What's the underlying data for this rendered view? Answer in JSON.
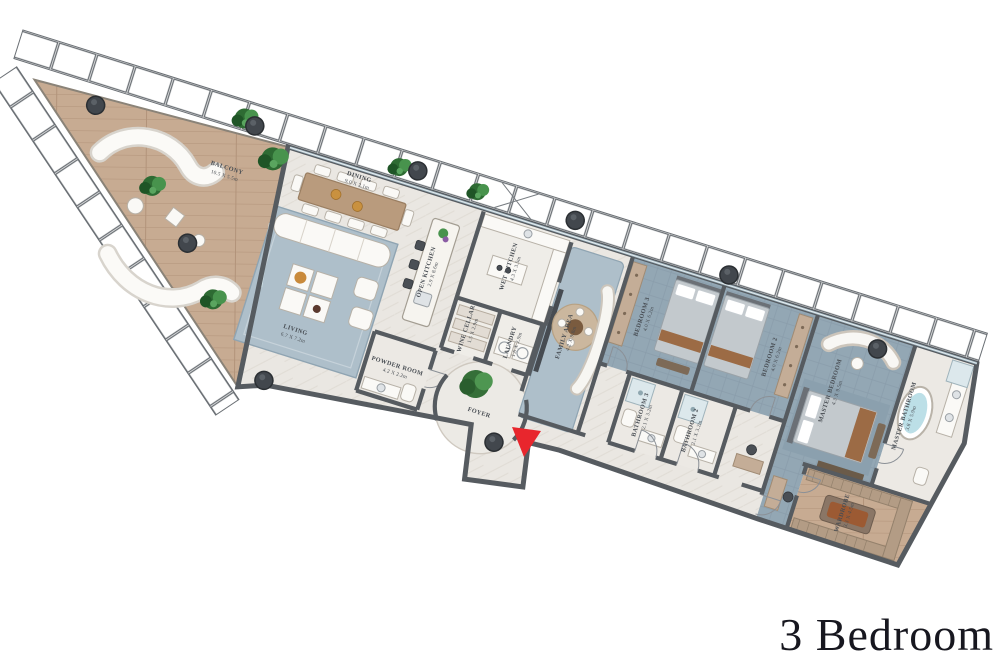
{
  "title": "3 Bedroom",
  "colors": {
    "arrow": "#e8262d",
    "wood": "#c7ab92",
    "marble": "#eae7e2",
    "carpet": "#93a7b4",
    "wall": "#565b60",
    "title_text": "#17171f"
  },
  "plan": {
    "rooms": {
      "balcony": {
        "name": "BALCONY",
        "dims": "10.5 X 5.5m"
      },
      "dining": {
        "name": "DINING",
        "dims": "9.0 X 2.1m"
      },
      "living": {
        "name": "LIVING",
        "dims": "6.7 X 7.2m"
      },
      "open_kitchen": {
        "name": "OPEN KITCHEN",
        "dims": "2.9 X 8.6m"
      },
      "wet_kitchen": {
        "name": "WET KITCHEN",
        "dims": "4.3 X 3.5m"
      },
      "wine_cellar": {
        "name": "WINE CELLAR",
        "dims": "1.5 X 2.9m"
      },
      "laundry": {
        "name": "LAUNDRY",
        "dims": "1.6 X 2.9m"
      },
      "powder_room": {
        "name": "POWDER ROOM",
        "dims": "4.2 X 2.2m"
      },
      "foyer": {
        "name": "FOYER",
        "dims": ""
      },
      "family_area": {
        "name": "FAMILY AREA",
        "dims": "4.2 X 9.8m"
      },
      "bedroom_3": {
        "name": "BEDROOM 3",
        "dims": "4.0 X 6.2m"
      },
      "bathroom_3": {
        "name": "BATHROOM 3",
        "dims": "2.1 X 3.2m"
      },
      "bathroom_2": {
        "name": "BATHROOM 2",
        "dims": "2.1 X 3.2m"
      },
      "bedroom_2": {
        "name": "BEDROOM 2",
        "dims": "4.0 X 6.2m"
      },
      "master_bedroom": {
        "name": "MASTER BEDROOM",
        "dims": "4.3 X 9.5m"
      },
      "master_bathroom": {
        "name": "MASTER BATHROOM",
        "dims": "3.8 X 5.9m"
      },
      "wardrobe": {
        "name": "WARDROBE",
        "dims": "3.3 X 4.5m"
      }
    }
  }
}
